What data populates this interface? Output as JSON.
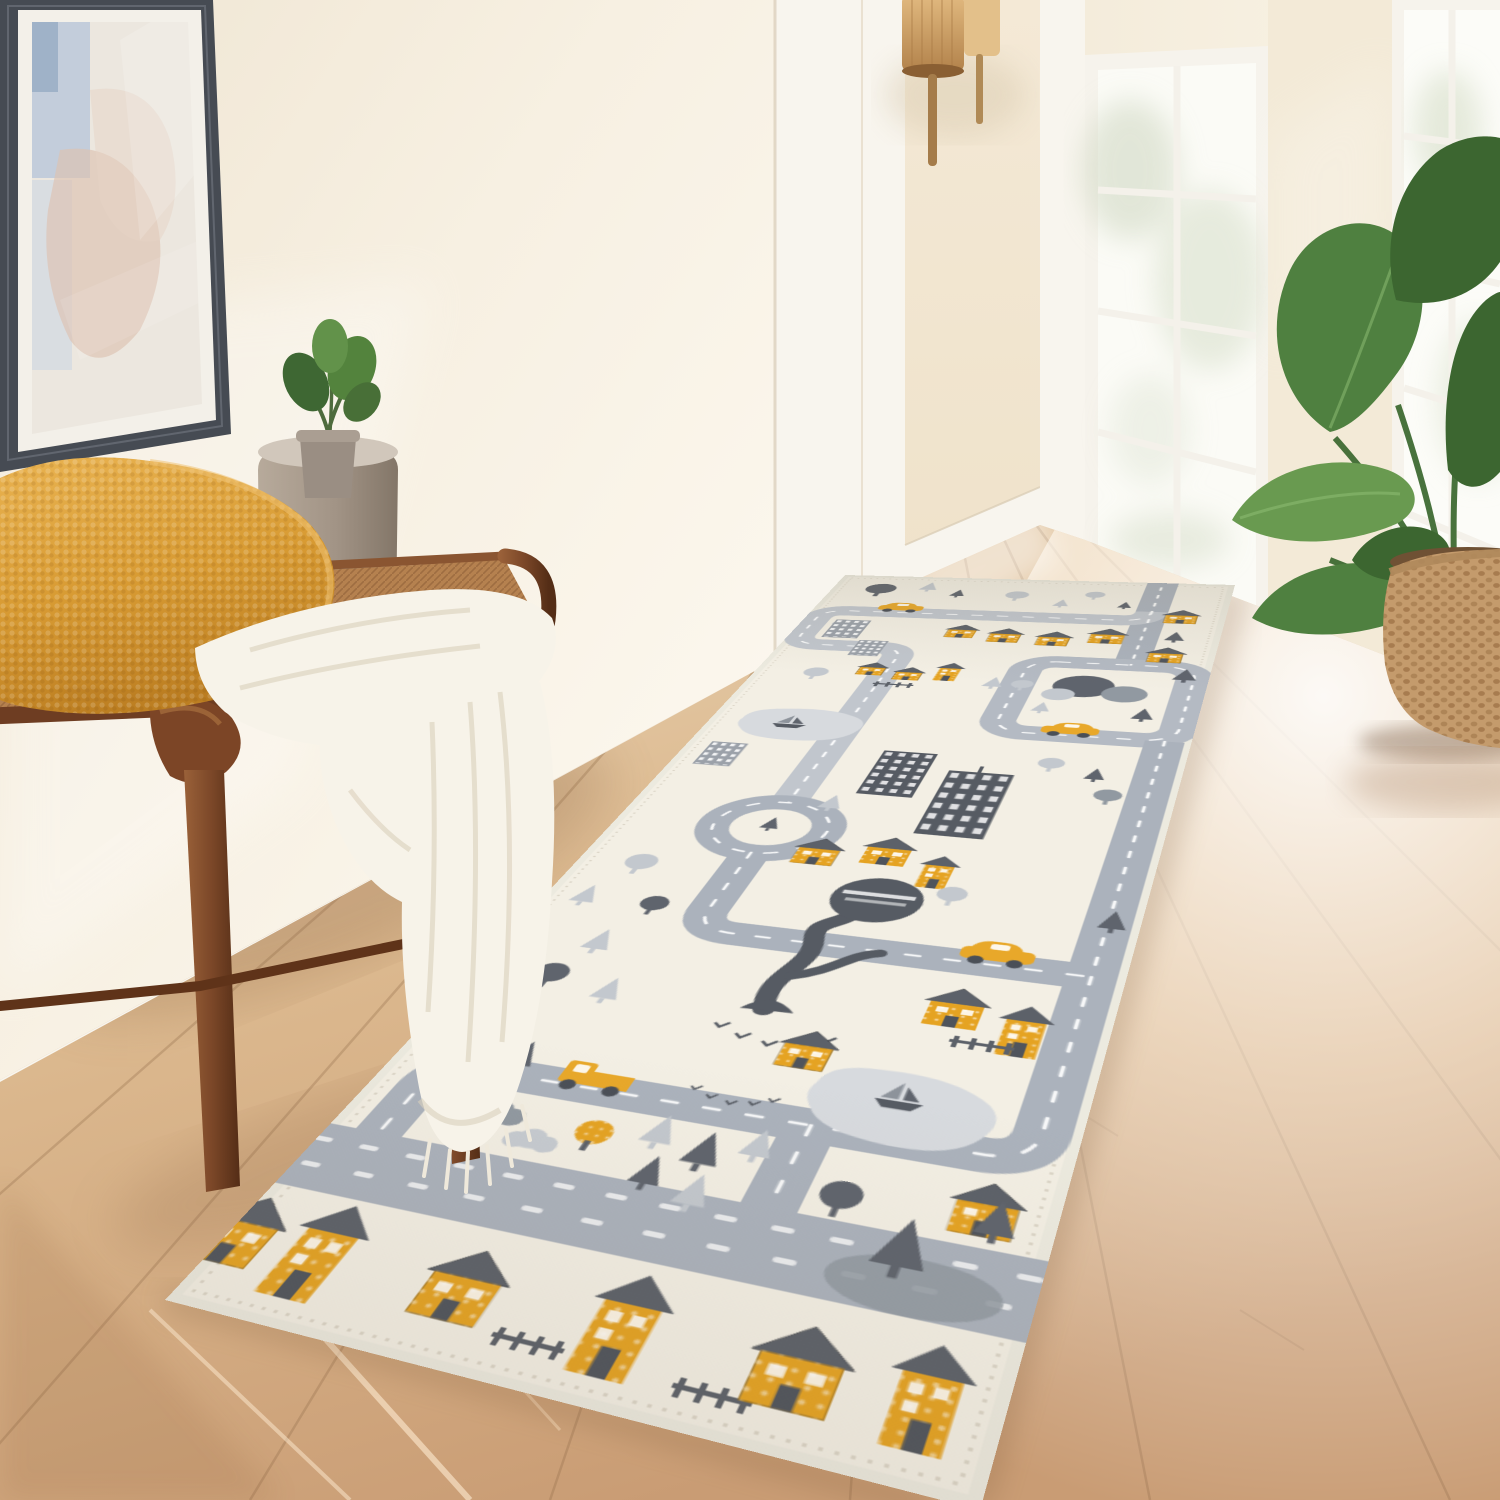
{
  "meta": {
    "kind": "interior product photograph (no text in image)",
    "subject": "Kids city road-map runner rug in a sunlit hallway entryway"
  },
  "colors": {
    "rugBase": "#f3efe4",
    "rugYellow": "#e5a322",
    "roofDark": "#5c6169",
    "dashWhite": "#ffffff",
    "bldgDark": "#565b63",
    "bldgLight": "#9ba1a9",
    "treeLight": "#c3c8ce",
    "treeMid": "#9199a1",
    "treeDark": "#5f646d",
    "pond": "#d7dade",
    "cloud": "#c6cbd1",
    "road": "#abb2bc",
    "roadLight": "#c1c6cd",
    "roadMid": "#b4bac3",
    "wallLeft": "#f6efe1",
    "wallBack": "#f2e6d0",
    "wallRight": "#f5edda",
    "trimWhite": "#f8f5ee",
    "floorFar": "#e8d4b6",
    "floorMid": "#d8b48c",
    "floorNear": "#c59873",
    "benchWood": "#7b4728",
    "benchWoodDark": "#58301a",
    "benchWeave": "#b5814f",
    "pillowGold": "#d99c35",
    "throwCream": "#f7f3e9",
    "stoolTaupe": "#a89a8c",
    "leafDark": "#3c6630",
    "leafMid": "#4f8040",
    "leafLight": "#699a50",
    "basketTan": "#c49b6c",
    "rattan": "#cc9d61",
    "brass": "#a57c4a",
    "frameGray": "#464b53",
    "matWhite": "#f3f0e9",
    "artBlue": "#b9c7d9",
    "artBlush": "#ddc2b0"
  },
  "objects": {
    "scene": "Sunlit entryway hallway with a kids road-map runner rug",
    "rug": "Cream kids play runner rug with gray roads, yellow houses, cars and gray trees",
    "bench": "Walnut wood bench with woven rope seat",
    "pillow": "Mustard textured throw pillow",
    "throw": "Chunky cream knit throw blanket with fringe",
    "side_table": "Taupe ceramic drum side table",
    "small_plant": "Small potted green plant on side table",
    "artwork": "Large framed abstract wall art",
    "sconce": "Rattan cylinder wall sconce with brass stems",
    "window_left": "Tall white paned window by the hallway",
    "window_right": "White French glass door with garden light",
    "big_plant": "Bird of paradise plant in woven seagrass basket",
    "floor": "Light oak plank floor washed with sunlight"
  },
  "rug_design": {
    "style": "cross-stitch knit texture city play map",
    "motifs": [
      "gray roads with white dashed center lines",
      "roundabout with pine",
      "yellow gabled houses with charcoal roofs",
      "dark high-rise buildings with white window grids",
      "gray apartment blocks",
      "round trees and pine trees in three grays",
      "dark gnarled treehouse tree with white platform slats",
      "two gray ponds with sailboats",
      "yellow cars",
      "yellow pickup truck",
      "gray clouds",
      "small fences and birds",
      "bottom gray road band with white traffic marks",
      "stitched cream border"
    ]
  }
}
